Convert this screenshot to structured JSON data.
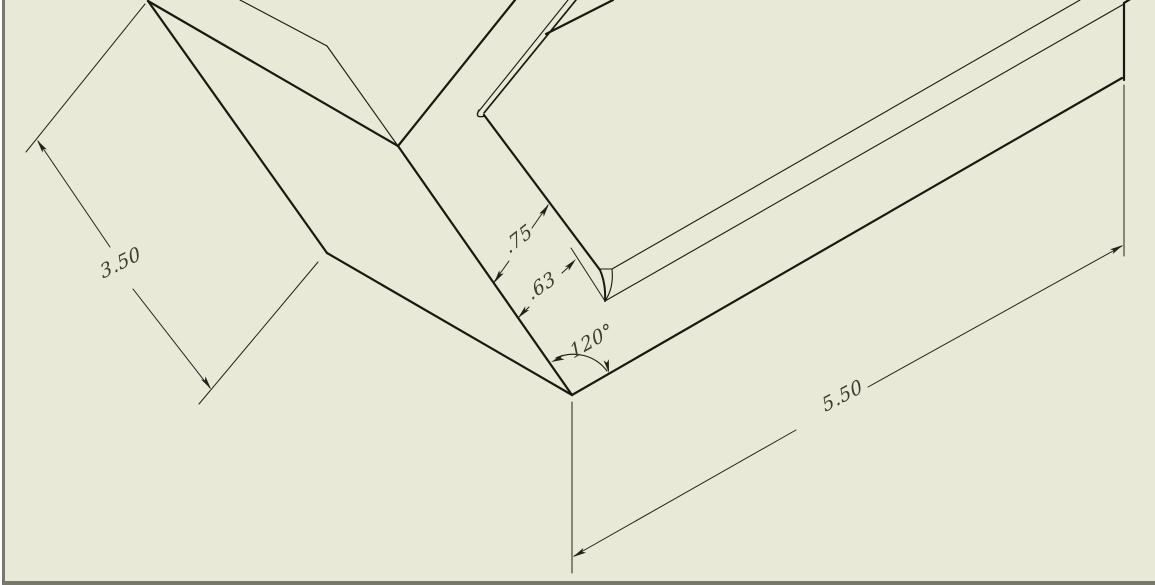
{
  "window": {
    "background": "#e9e9d7",
    "edge_gray": "#78786f",
    "edge_white": "#ffffff"
  },
  "drawing": {
    "line_color": "#191911",
    "dim_line_color": "#22221a",
    "text_color": "#3c3c30",
    "font_size": 19,
    "dimensions": [
      {
        "id": "plate-width",
        "label": "3.50",
        "x": 121,
        "y": 264,
        "angle": -27
      },
      {
        "id": "flange-width",
        "label": ".75",
        "x": 519,
        "y": 240,
        "angle": -38
      },
      {
        "id": "lip-height",
        "label": ".63",
        "x": 542,
        "y": 287,
        "angle": -35
      },
      {
        "id": "bend-angle",
        "label": "120°",
        "x": 592,
        "y": 342,
        "angle": -30
      },
      {
        "id": "part-length",
        "label": "5.50",
        "x": 843,
        "y": 397,
        "angle": -28
      }
    ],
    "geometry": {
      "part_edges": [
        [
          148,
          1,
          327,
          253,
          2.2
        ],
        [
          327,
          253,
          572,
          395,
          2.2
        ],
        [
          572,
          395,
          1122,
          78,
          2.2
        ],
        [
          148,
          1,
          398,
          146,
          2.2
        ],
        [
          398,
          146,
          572,
          395,
          2.2
        ],
        [
          398,
          146,
          515,
          0,
          2.2
        ],
        [
          576,
          0,
          484,
          113,
          1.7
        ],
        [
          484,
          115,
          600,
          270,
          2.2
        ],
        [
          1124,
          3,
          1124,
          80,
          2.2
        ],
        [
          546,
          34,
          613,
          0,
          2.2
        ],
        [
          1124,
          3,
          1132,
          -2,
          2.2
        ]
      ],
      "tangent_edges": [
        [
          568,
          0,
          479,
          111,
          1.1
        ],
        [
          240,
          0,
          327,
          46,
          1.1
        ],
        [
          327,
          46,
          398,
          146,
          1.1
        ],
        [
          612,
          269,
          1080,
          0,
          1.1
        ],
        [
          605,
          301,
          1124,
          4,
          1.1
        ],
        [
          600,
          269,
          612,
          269,
          1.1
        ]
      ],
      "curves": [
        {
          "d": "M 600,270 Q 606,284 605,301",
          "w": 2.0
        },
        {
          "d": "M 605,301 Q 614,288 612,269",
          "w": 1.1
        },
        {
          "d": "M 479,110 Q 474,119 485,116",
          "w": 1.4
        },
        {
          "d": "M 556,358 A 42,42 0 0 1 607,371",
          "w": 1.1
        }
      ],
      "dim_lines": [
        [
          38,
          141,
          110,
          247
        ],
        [
          133,
          289,
          210,
          388
        ],
        [
          574,
          556,
          796,
          430
        ],
        [
          868,
          387,
          1122,
          246
        ],
        [
          494,
          282,
          509,
          261
        ],
        [
          532,
          228,
          548,
          205
        ],
        [
          519,
          317,
          529,
          307
        ],
        [
          562,
          273,
          573,
          263
        ]
      ],
      "ext_lines": [
        [
          145,
          4,
          26,
          152
        ],
        [
          318,
          262,
          199,
          404
        ],
        [
          572,
          402,
          572,
          573
        ],
        [
          1124,
          85,
          1124,
          256
        ],
        [
          571,
          248,
          605,
          301
        ]
      ],
      "arrows": [
        [
          37,
          140,
          -125
        ],
        [
          211,
          389,
          55
        ],
        [
          573,
          557,
          150
        ],
        [
          1123,
          245,
          -30
        ],
        [
          494,
          283,
          124
        ],
        [
          549,
          204,
          -56
        ],
        [
          518,
          318,
          133
        ],
        [
          576,
          259,
          -47
        ],
        [
          551,
          362,
          158
        ],
        [
          609,
          373,
          78
        ]
      ]
    }
  }
}
